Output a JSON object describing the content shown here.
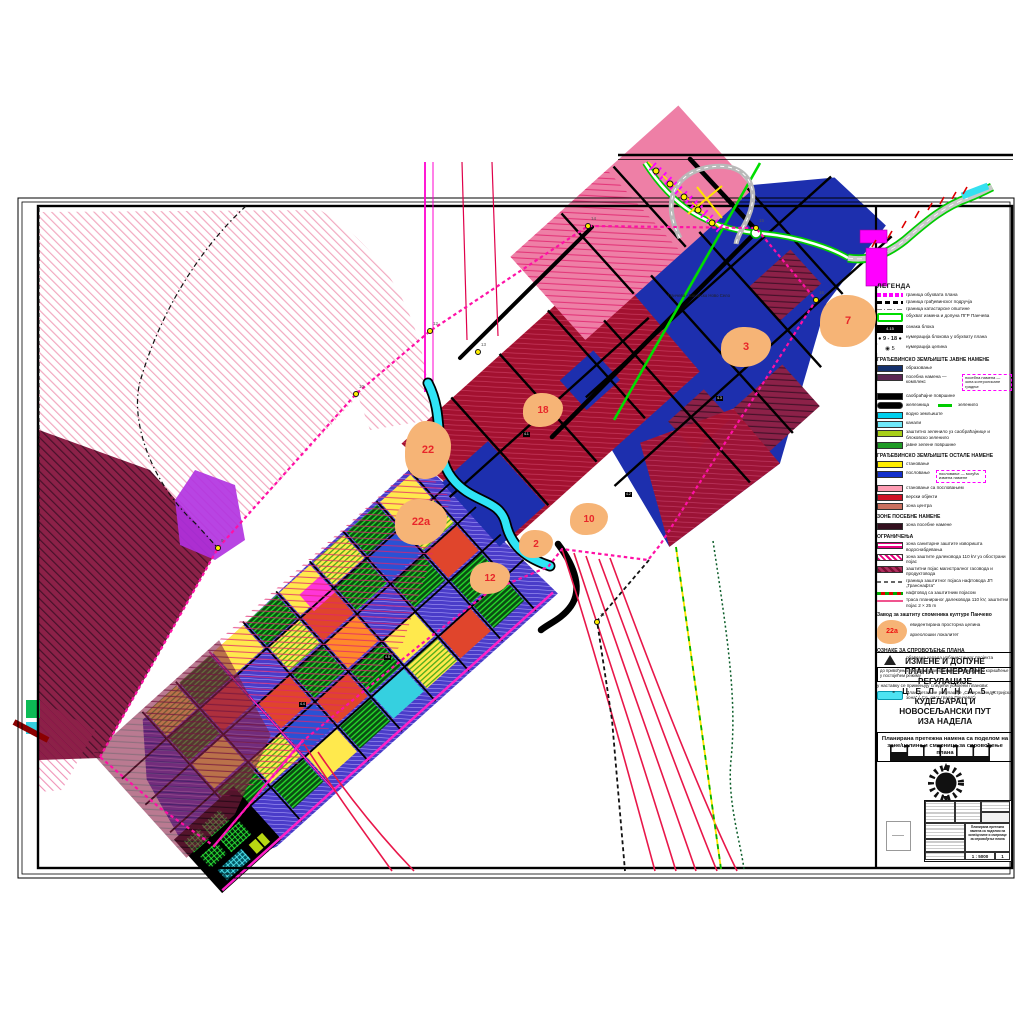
{
  "sheet": {
    "title_lines": [
      "ИЗМЕНЕ И ДОПУНЕ",
      "ПЛАНА ГЕНЕРАЛНЕ РЕГУЛАЦИЈЕ",
      "- Ц Е Л И Н А  5 -",
      "КУДЕЉАРАЦ И",
      "НОВОСЕЉАНСКИ ПУТ",
      "ИЗА НАДЕЛА"
    ],
    "subtitle": "Планирана претежна намена са поделом на зоне/целине и смернице за спровођење плана",
    "bottom_table": {
      "scale_value": "1 : 5000",
      "sheet_number": "1"
    }
  },
  "map": {
    "road_label": "Панчево - Банатско Ново Село",
    "zone_badges": [
      {
        "id": "7",
        "x": 848,
        "y": 321,
        "w": 56,
        "h": 52
      },
      {
        "id": "3",
        "x": 746,
        "y": 347,
        "w": 50,
        "h": 40
      },
      {
        "id": "18",
        "x": 543,
        "y": 410,
        "w": 40,
        "h": 34
      },
      {
        "id": "22",
        "x": 428,
        "y": 450,
        "w": 46,
        "h": 58
      },
      {
        "id": "22a",
        "x": 421,
        "y": 522,
        "w": 52,
        "h": 46
      },
      {
        "id": "10",
        "x": 589,
        "y": 519,
        "w": 38,
        "h": 32
      },
      {
        "id": "2",
        "x": 536,
        "y": 544,
        "w": 34,
        "h": 28
      },
      {
        "id": "12",
        "x": 490,
        "y": 578,
        "w": 40,
        "h": 32
      }
    ],
    "vertex_markers": [
      {
        "n": "9",
        "x": 218,
        "y": 548
      },
      {
        "n": "10",
        "x": 356,
        "y": 394
      },
      {
        "n": "12",
        "x": 430,
        "y": 331
      },
      {
        "n": "13",
        "x": 478,
        "y": 352
      },
      {
        "n": "14",
        "x": 588,
        "y": 226
      },
      {
        "n": "15",
        "x": 756,
        "y": 228
      },
      {
        "n": "16",
        "x": 816,
        "y": 300
      },
      {
        "n": "11",
        "x": 597,
        "y": 622
      }
    ],
    "block_tags": [
      {
        "t": "4.1",
        "x": 523,
        "y": 432
      },
      {
        "t": "4.2",
        "x": 625,
        "y": 492
      },
      {
        "t": "4.3",
        "x": 716,
        "y": 396
      },
      {
        "t": "4.4",
        "x": 299,
        "y": 702
      },
      {
        "t": "4.5",
        "x": 384,
        "y": 655
      }
    ]
  },
  "legend": {
    "groups": [
      {
        "header": "ЛЕГЕНДА",
        "title": true,
        "items": [
          {
            "swatch": "line-magenta-dash",
            "label": "граница обухвата плана"
          },
          {
            "swatch": "line-black-dash",
            "label": "граница грађевинског подручја"
          },
          {
            "swatch": "line-gray-dashdot",
            "label": "граница катастарске општине"
          },
          {
            "swatch": "outline-green",
            "label": "обухват измена и допуна ПГР Панчева"
          },
          {
            "swatch": "black-tag",
            "tag": "4.15",
            "label": "ознака блока"
          },
          {
            "swatch": "blocks-range",
            "tag": "● 9 - 18 ●",
            "label": "нумерација блокова у обухвату плана"
          },
          {
            "swatch": "circle-num",
            "tag": "◉ 5",
            "label": "нумерација целина"
          }
        ]
      },
      {
        "header": "ГРАЂЕВИНСКО ЗЕМЉИШТЕ ЈАВНЕ НАМЕНЕ",
        "items": [
          {
            "swatch": "sw-navy",
            "label": "образовање"
          },
          {
            "swatch": "sw-purple",
            "label": "посебна намена — комплекс",
            "note": "посебна намена — зона контролисане градње"
          },
          {
            "swatch": "sw-black",
            "label": "саобраћајне површине"
          },
          {
            "swatch": "sw-rail",
            "label": "железница",
            "note2": "зеленило"
          },
          {
            "swatch": "sw-cyan",
            "label": "водно земљиште"
          },
          {
            "swatch": "sw-lightcyan",
            "label": "канали"
          },
          {
            "swatch": "sw-yellowgreen",
            "label": "заштитно зеленило уз саобраћајнице и блоковско зеленило"
          },
          {
            "swatch": "sw-green",
            "label": "јавне зелене површине"
          }
        ]
      },
      {
        "header": "ГРАЂЕВИНСКО ЗЕМЉИШТЕ ОСТАЛЕ НАМЕНЕ",
        "items": [
          {
            "swatch": "sw-yellow",
            "label": "становање"
          },
          {
            "swatch": "sw-blue",
            "label": "пословање",
            "note": "пословање — могућа измена намене"
          },
          {
            "swatch": "sw-pink",
            "label": "становање са пословањем"
          },
          {
            "swatch": "sw-red",
            "label": "верски објекти"
          },
          {
            "swatch": "sw-salmon",
            "label": "зона центра"
          }
        ]
      },
      {
        "header": "ЗОНЕ ПОСЕБНЕ НАМЕНЕ",
        "items": [
          {
            "swatch": "sw-darkmaroon",
            "label": "зона посебне намене"
          }
        ]
      },
      {
        "header": "ОГРАНИЧЕЊА",
        "items": [
          {
            "swatch": "hatch-magenta",
            "label": "зона санитарне заштите изворишта водоснабдевања"
          },
          {
            "swatch": "hatch-magenta2",
            "label": "зона заштите далековода 110 kV уз обострани појас"
          },
          {
            "swatch": "hatch-maroon",
            "label": "заштитни појас магистралног гасовода и продуктовода"
          },
          {
            "swatch": "line-gray-dash",
            "label": "граница заштитног појаса нафтовода ЈП „Транснафта“"
          },
          {
            "swatch": "line-oil",
            "label": "нафтовод са заштитним појасом"
          },
          {
            "swatch": "line-pink",
            "label": "траса планираног далековода 110 kV, заштитни појас 2 × 25 m"
          }
        ]
      }
    ],
    "heritage": {
      "header": "Завод за заштиту споменика културе Панчево",
      "badge": "22а",
      "items": [
        "евидентирана просторна целина",
        "археолошки локалитет"
      ]
    },
    "implementation": {
      "header": "ОЗНАКЕ ЗА СПРОВОЂЕЊЕ ПЛАНА",
      "items": [
        {
          "swatch": "triangle",
          "label": "обавезна израда урбанистичког пројекта"
        },
        {
          "swatch": "box-text",
          "label": "до привођења простора планираној намени могуће је коришћење у постојећем режиму"
        },
        {
          "swatch": "plain",
          "label": "у наставку се примењују следећи усвојени планови:"
        },
        {
          "swatch": "cyan-box",
          "label": "План детаљне регулације „Северна индустријска зона“ („Сл. лист града Панчева“)"
        }
      ]
    }
  },
  "colors": {
    "boundary_magenta": "#ff10a6",
    "zone_blue": "#1d2fae",
    "zone_crimson": "#a31130",
    "zone_pink": "#ee7fa6",
    "badge_orange": "#f6b476",
    "badge_number_red": "#e8262a",
    "canal_cyan": "#2fe4f6",
    "road_green": "#00cc00"
  }
}
